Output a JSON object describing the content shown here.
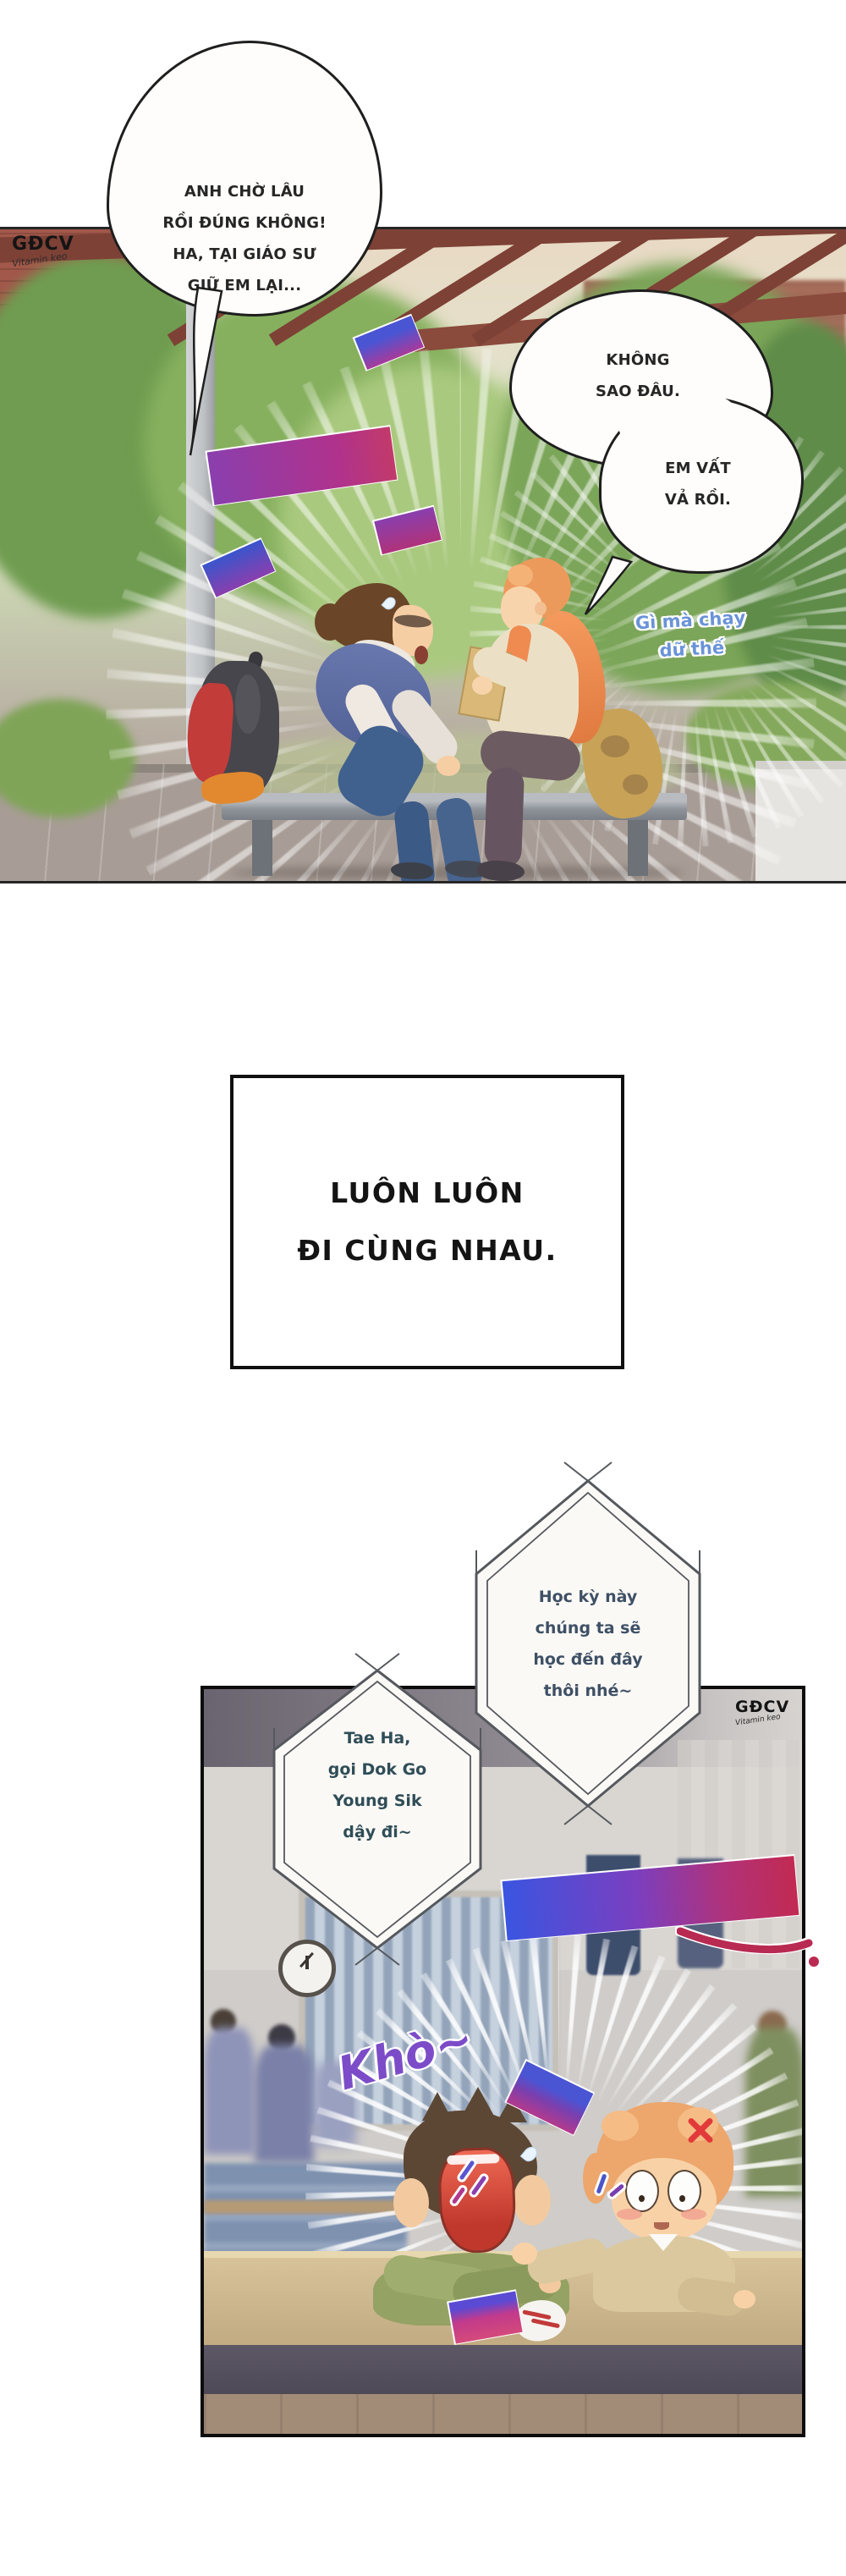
{
  "watermark": {
    "brand": "GĐCV",
    "signature": "Vitamin keo"
  },
  "panel_top": {
    "bubble_left": {
      "lines": [
        "ANH CHỜ LÂU",
        "RỒI ĐÚNG KHÔNG!",
        "HA, TẠI GIÁO SƯ",
        "GIỮ EM LẠI..."
      ]
    },
    "bubble_right_top": {
      "lines": [
        "KHÔNG",
        "SAO ĐÂU."
      ]
    },
    "bubble_right_bottom": {
      "lines": [
        "EM VẤT",
        "VẢ RỒI."
      ]
    },
    "sfx_gasp": "Hộc",
    "sfx_sigh": "Aigoo~",
    "aside": {
      "lines": [
        "Gì mà chạy",
        "dữ thế"
      ]
    }
  },
  "narration": {
    "lines": [
      "LUÔN LUÔN",
      "ĐI CÙNG NHAU."
    ]
  },
  "panel_bottom": {
    "hex_bubble_right": {
      "lines": [
        "Học kỳ này",
        "chúng ta sẽ",
        "học đến đây",
        "thôi nhé~"
      ]
    },
    "hex_bubble_left": {
      "lines": [
        "Tae Ha,",
        "gọi Dok Go",
        "Young Sik",
        "dậy đi~"
      ]
    },
    "sfx_laugh": "Ahahaha~",
    "sfx_snore": "Khò~",
    "sfx_shake": "Lắc"
  },
  "colors": {
    "sfx_purple": "#7c4cc8",
    "sfx_magenta": "#b43a8c",
    "sfx_blue": "#4a55d4",
    "aside_blue": "#6a93d8",
    "hex_text_right": "#3e5065",
    "hex_text_left": "#2f4d57",
    "laugh_gradient": [
      "#3a55e0",
      "#7a3fc0",
      "#c22a52"
    ]
  }
}
